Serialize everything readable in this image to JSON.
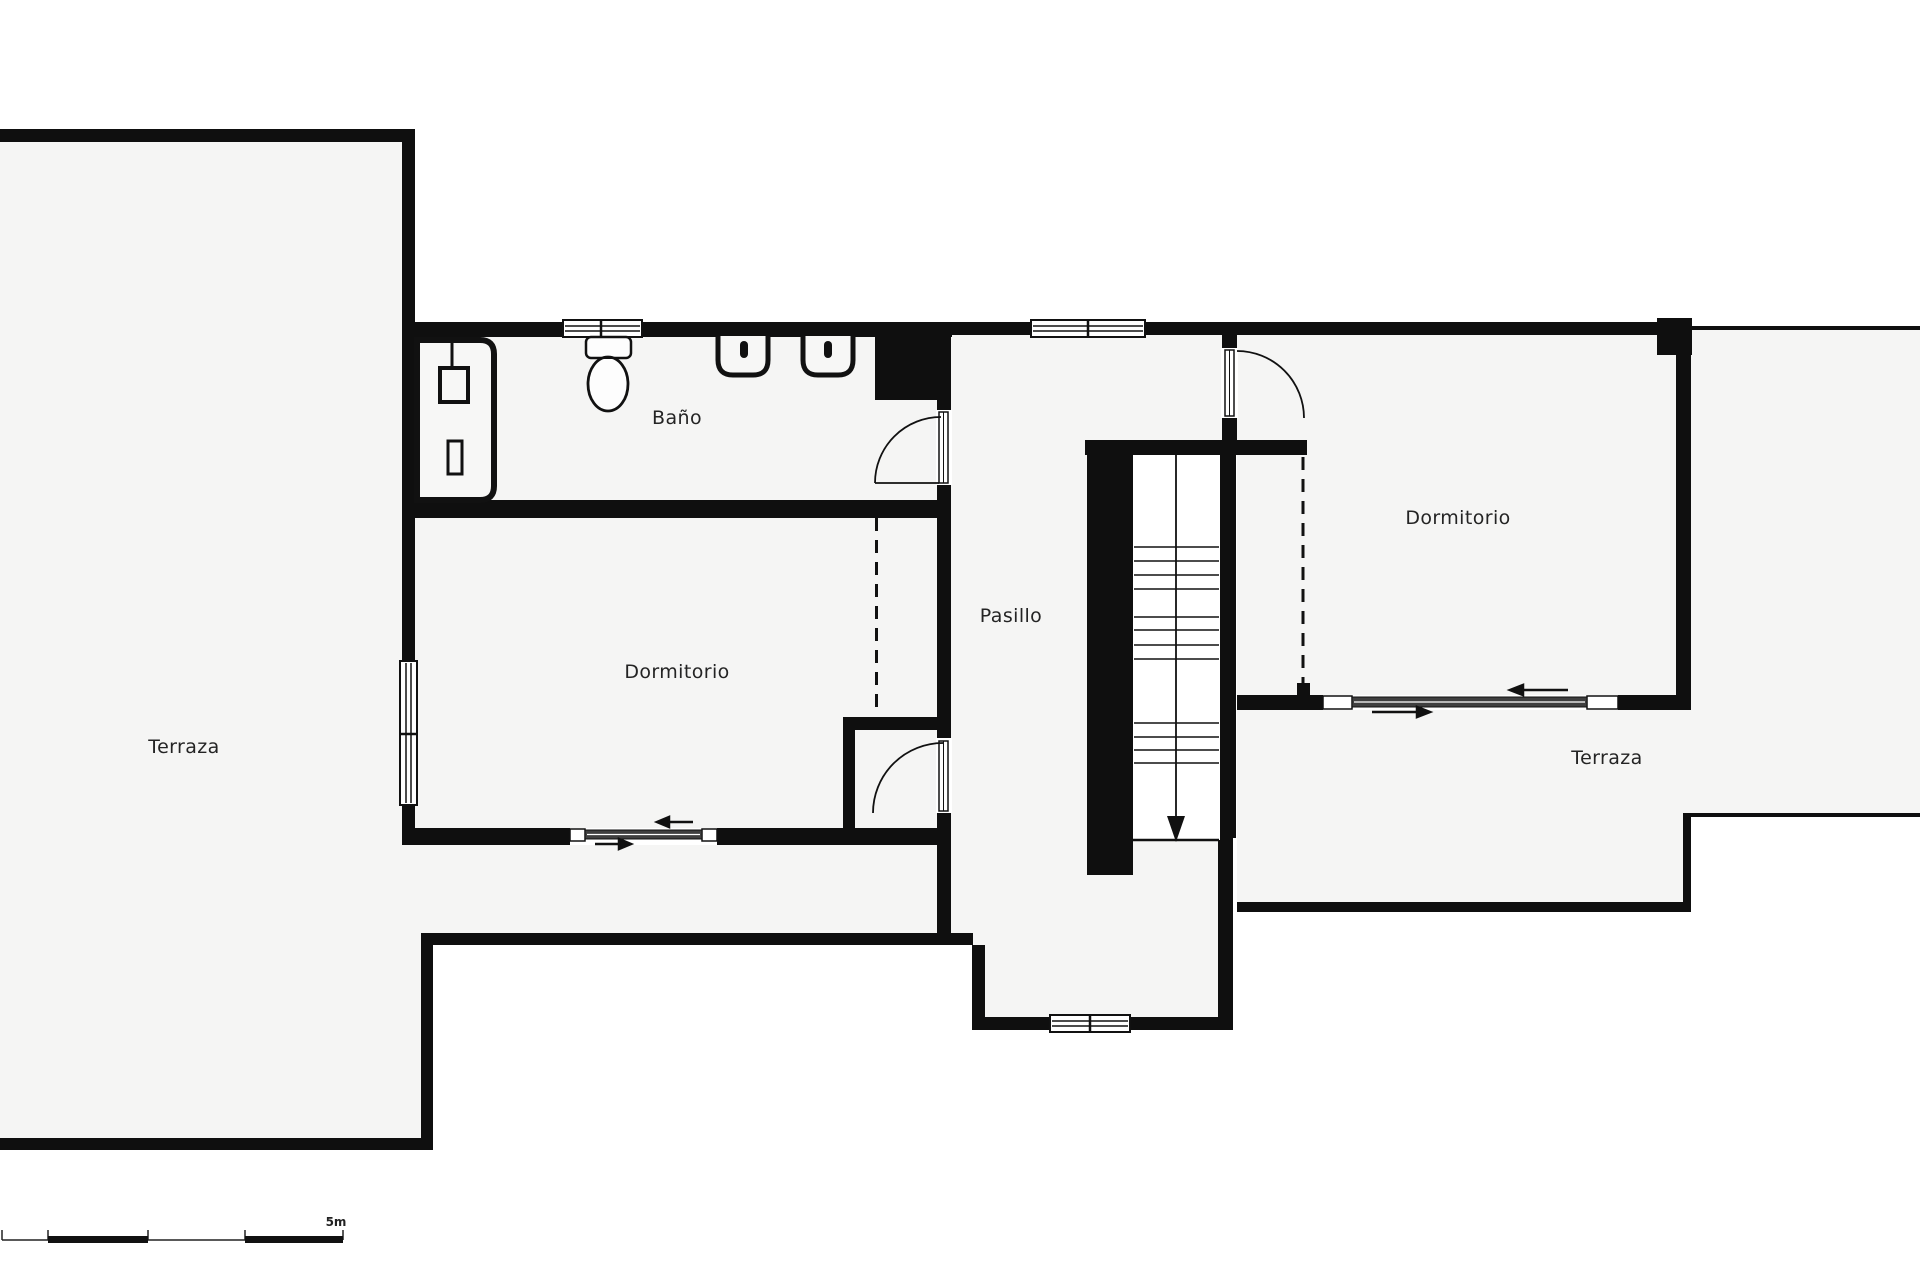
{
  "plan": {
    "rooms": [
      {
        "id": "terraza-left",
        "label": "Terraza"
      },
      {
        "id": "bano",
        "label": "Baño"
      },
      {
        "id": "dormitorio-left",
        "label": "Dormitorio"
      },
      {
        "id": "pasillo",
        "label": "Pasillo"
      },
      {
        "id": "dormitorio-right",
        "label": "Dormitorio"
      },
      {
        "id": "terraza-right",
        "label": "Terraza"
      }
    ],
    "scale_bar": {
      "label": "5m"
    },
    "colors": {
      "wall": "#0f0f0f",
      "floor": "#f5f5f4",
      "outside": "#ffffff",
      "glass_band": "#3f3f3f",
      "thin_line": "#1a1a1a"
    },
    "icons": [
      "toilet-icon",
      "sink-icon",
      "shower-enclosure-icon",
      "stairs-down-arrow-icon",
      "door-swing-icon",
      "sliding-door-arrow-icon",
      "wardrobe-dashed-line",
      "duct-column"
    ]
  }
}
